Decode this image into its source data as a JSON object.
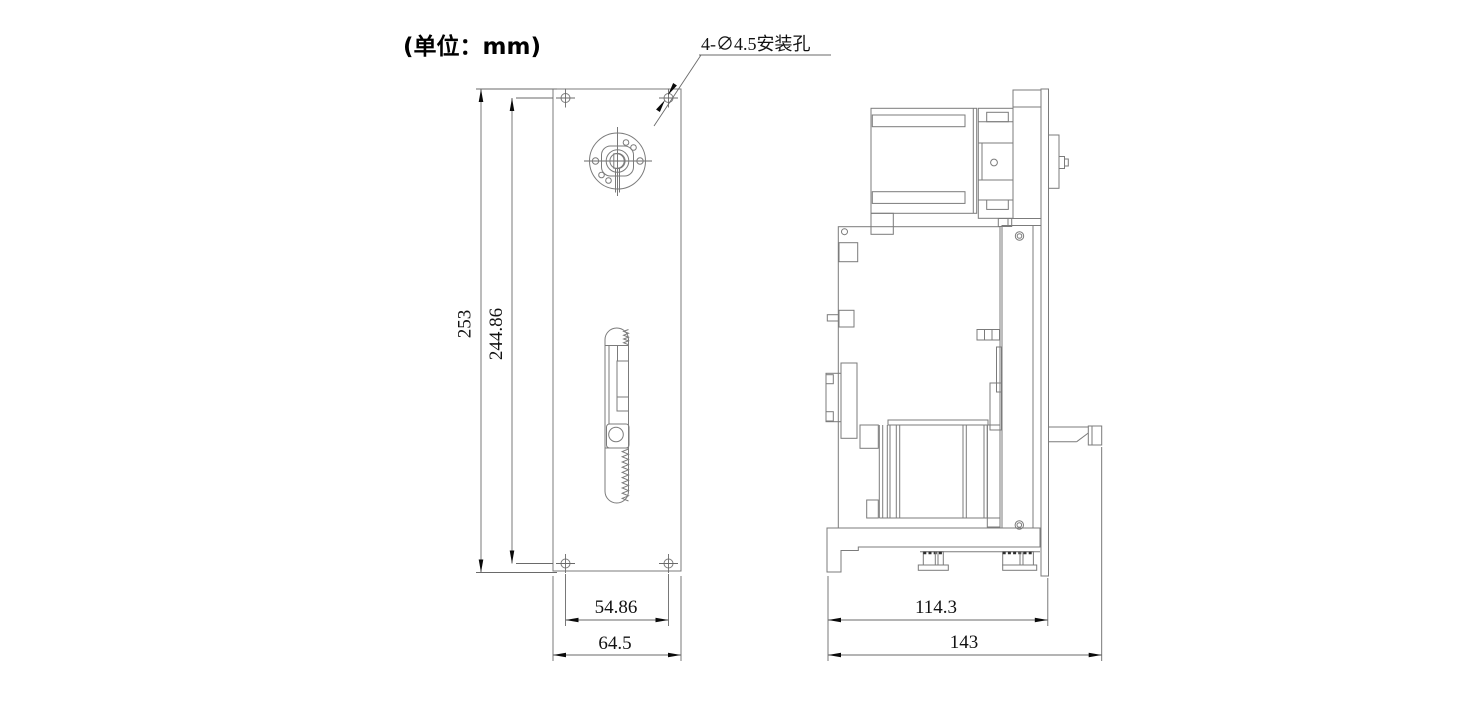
{
  "title": {
    "units_label": "(单位：mm)"
  },
  "callout": {
    "mounting_holes": "4-∅4.5安装孔"
  },
  "dimensions": {
    "front": {
      "total_height": "253",
      "hole_span_vertical": "244.86",
      "hole_span_horizontal": "54.86",
      "total_width": "64.5"
    },
    "side": {
      "body_depth": "114.3",
      "total_depth": "143"
    }
  },
  "colors": {
    "background": "#ffffff",
    "geometry_line": "#7b7b7b",
    "dimension_line": "#6a6a6a",
    "text": "#121212",
    "arrow": "#0a0a0a"
  }
}
